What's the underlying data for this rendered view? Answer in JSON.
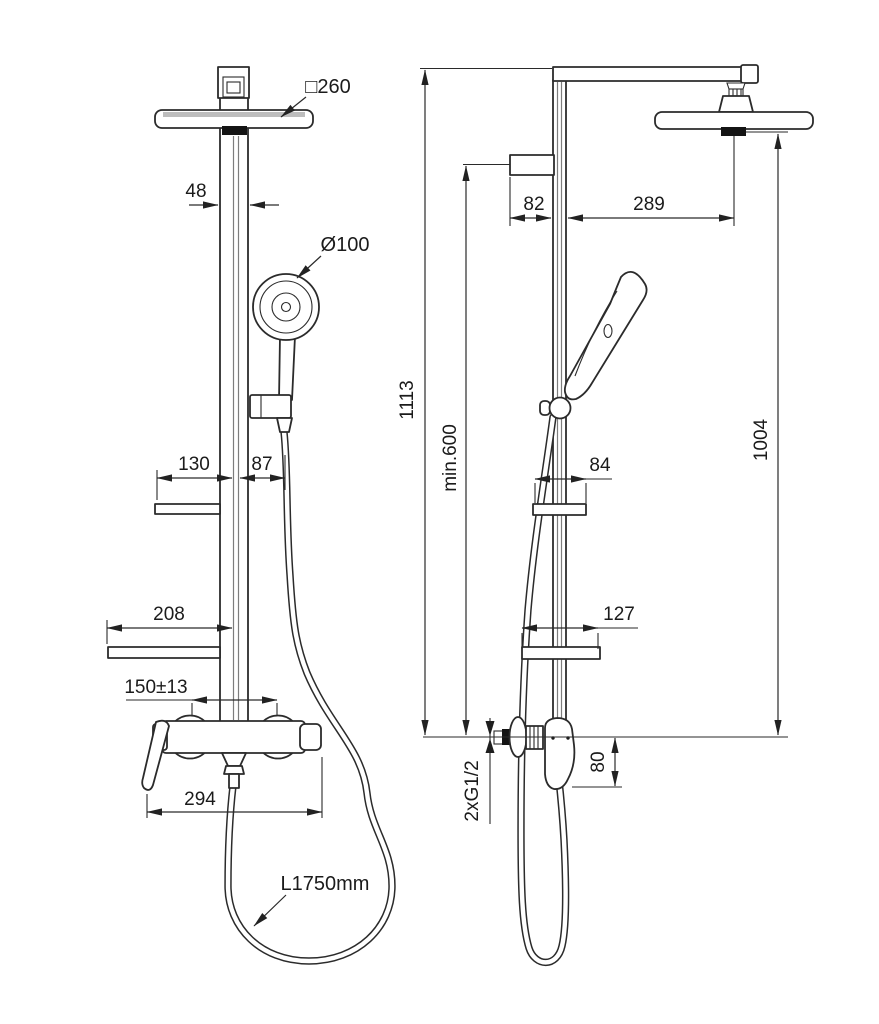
{
  "drawing": {
    "ink_color": "#2b2b2b",
    "background_color": "#ffffff",
    "nozzle_color": "#141414"
  },
  "dims": {
    "head_square": "□260",
    "hand_diameter": "Ø100",
    "column_width": "48",
    "shelf_soap_left": "130",
    "shelf_soap_right": "87",
    "shelf_low_width": "208",
    "mount_centers": "150±13",
    "mixer_width": "294",
    "hose_length": "L1750mm",
    "bracket_depth": "82",
    "head_reach": "289",
    "total_height": "1113",
    "min_clearance": "min.600",
    "head_height": "1004",
    "shelf_soap_depth": "84",
    "shelf_low_depth": "127",
    "connections": "2xG1/2",
    "handle_drop": "80"
  }
}
